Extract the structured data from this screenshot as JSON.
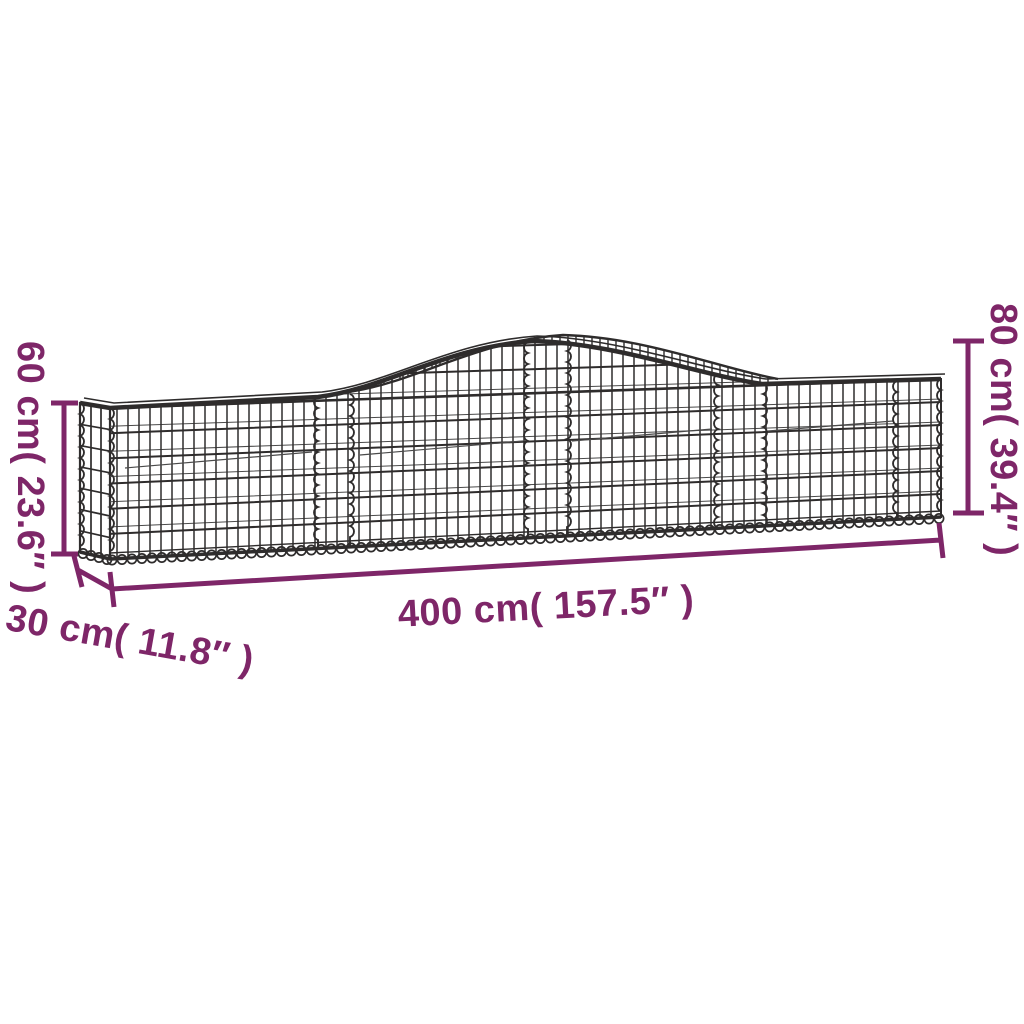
{
  "diagram": {
    "subject": "Arched gabion basket wire-mesh dimension diagram",
    "labels": {
      "height_left": "60 cm( 23.6″ )",
      "height_right": "80 cm( 39.4″ )",
      "length": "400 cm( 157.5″ )",
      "depth": "30 cm( 11.8″ )"
    },
    "colors": {
      "dimension": "#7e2668",
      "wire": "#2e2c2c",
      "background": "#ffffff"
    }
  }
}
